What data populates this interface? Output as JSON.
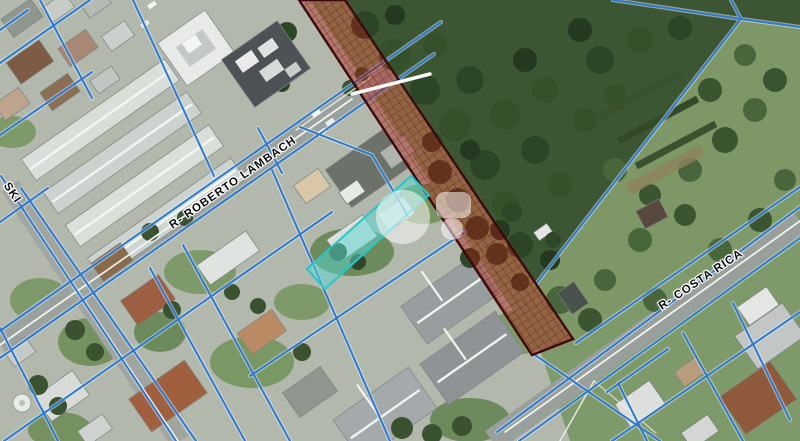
{
  "map": {
    "street_labels": {
      "roberto_lambach": "R- ROBERTO LAMBACH",
      "costa_rica": "R- COSTA RICA",
      "partial_left": "SKI"
    },
    "colors": {
      "parcel_line_blue": "#2e7ace",
      "line_casing_white": "#eef2f5",
      "red_parcel_fill": "rgba(170,30,20,0.42)",
      "red_parcel_stroke": "#3c0a0d",
      "cyan_parcel_fill": "rgba(85,215,209,0.5)",
      "cyan_parcel_stroke": "#27c6c9",
      "watermark_white": "#ffffff",
      "road_centerline_white": "#f6f8f5"
    }
  }
}
